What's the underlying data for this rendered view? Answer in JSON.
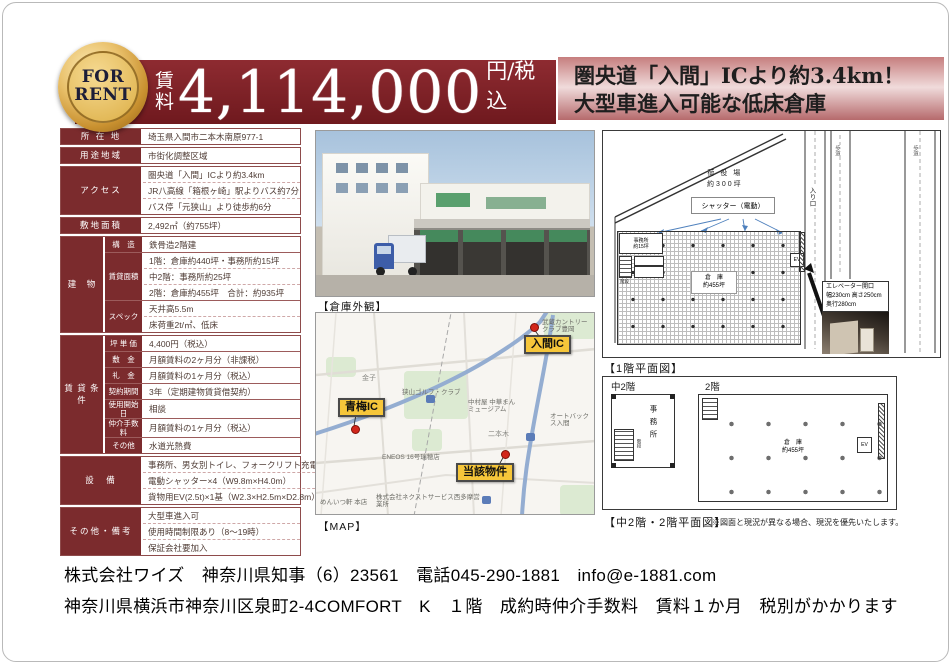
{
  "header": {
    "badge_line1": "FOR",
    "badge_line2": "RENT",
    "price_label_1": "賃",
    "price_label_2": "料",
    "price_value": "4,114,000",
    "price_unit": "円/税込",
    "catch_line1": "圏央道「入間」ICより約3.4km！",
    "catch_line2": "大型車進入可能な低床倉庫"
  },
  "table": {
    "location": {
      "label": "所 在 地",
      "value": "埼玉県入間市二本木南原977-1"
    },
    "zoning": {
      "label": "用途地域",
      "value": "市街化調整区域"
    },
    "access": {
      "label": "アクセス",
      "lines": [
        "圏央道「入間」ICより約3.4km",
        "JR八高線「箱根ヶ崎」駅よりバス約7分",
        "バス停「元狭山」より徒歩約6分"
      ]
    },
    "land": {
      "label": "敷地面積",
      "value": "2,492㎡（約755坪）"
    },
    "building": {
      "label": "建　物",
      "structure": {
        "label": "構　造",
        "value": "鉄骨造2階建"
      },
      "area": {
        "label": "賃貸面積",
        "lines": [
          "1階：倉庫約440坪・事務所約15坪",
          "中2階：事務所約25坪",
          "2階：倉庫約455坪　合計：約935坪"
        ]
      },
      "spec": {
        "label": "スペック",
        "lines": [
          "天井高5.5m",
          "床荷重2t/㎡、低床"
        ]
      }
    },
    "terms": {
      "label": "賃 貸 条 件",
      "rows": [
        {
          "label": "坪 単 価",
          "value": "4,400円（税込）"
        },
        {
          "label": "敷　金",
          "value": "月額賃料の2ヶ月分（非課税）"
        },
        {
          "label": "礼　金",
          "value": "月額賃料の1ヶ月分（税込）"
        },
        {
          "label": "契約期間",
          "value": "3年（定期建物賃貸借契約）"
        },
        {
          "label": "使用開始日",
          "value": "相談"
        },
        {
          "label": "仲介手数料",
          "value": "月額賃料の1ヶ月分（税込）"
        },
        {
          "label": "その他",
          "value": "水道光熱費"
        }
      ]
    },
    "equipment": {
      "label": "設　備",
      "lines": [
        "事務所、男女別トイレ、フォークリフト充電設備×4",
        "電動シャッター×4（W9.8m×H4.0m）",
        "貨物用EV(2.5t)×1基（W2.3×H2.5m×D2.8m）"
      ]
    },
    "notes": {
      "label": "その他・備考",
      "lines": [
        "大型車進入可",
        "使用時間制限あり（8～19時）",
        "保証会社要加入"
      ]
    }
  },
  "photo": {
    "caption": "【倉庫外観】"
  },
  "map": {
    "caption": "【MAP】",
    "marker_iruma": "入間IC",
    "marker_oume": "青梅IC",
    "marker_property": "当該物件",
    "poi": [
      "武蔵カントリークラブ豊岡",
      "狭山ゴルフ・クラブ",
      "中村屋 中華まん ミュージアム",
      "オートバックス入間",
      "金子",
      "二本木",
      "ENEOS 16号瑞穂店",
      "株式会社ネクストサービス西多摩営業所",
      "めんいつ軒 本店"
    ]
  },
  "plan1f": {
    "caption": "【1階平面図】",
    "yard_1": "荷 役 場",
    "yard_2": "約300坪",
    "shutter": "シャッター（電動）",
    "office_1": "事務所",
    "office_2": "約15坪",
    "stairs": "階段",
    "wh_1": "倉　庫",
    "wh_2": "約455坪",
    "entrance": "入り口",
    "sidewalk": "歩道",
    "ev": "EV",
    "callout_1": "エレベーター開口",
    "callout_2": "幅230cm 高さ250cm",
    "callout_3": "奥行280cm"
  },
  "plan2f": {
    "caption": "【中2階・2階平面図】",
    "note": "※図面と現況が異なる場合、現況を優先いたします。",
    "mezz": "中2階",
    "f2": "2階",
    "office": "事務所",
    "stairs": "階段",
    "wh_1": "倉　庫",
    "wh_2": "約455坪",
    "ev": "EV"
  },
  "footer": {
    "line1": "株式会社ワイズ　神奈川県知事（6）23561　電話045-290-1881　info@e-1881.com",
    "line2": "神奈川県横浜市神奈川区泉町2-4COMFORT　K　１階　成約時仲介手数料　賃料１か月　税別がかかります"
  }
}
